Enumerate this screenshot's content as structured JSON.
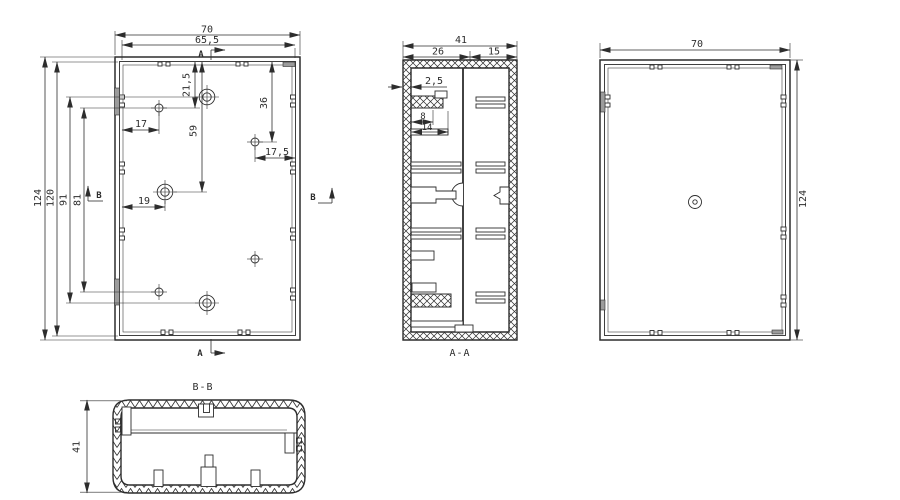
{
  "front_view": {
    "dim_width_outer": "70",
    "dim_width_inner": "65,5",
    "dim_height_outer": "124",
    "dim_height_inner": "120",
    "dim_boss_span": "91",
    "dim_hole_span": "81",
    "dim_hole_offset_x": "17",
    "dim_boss_offset_x": "19",
    "dim_hole_top_offset": "21,5",
    "dim_boss_center_offset": "59",
    "dim_right_hole_offset_y": "36",
    "dim_right_hole_offset_x": "17,5",
    "marker_a": "A",
    "marker_b": "B"
  },
  "section_aa": {
    "label": "A-A",
    "dim_width": "41",
    "dim_seg_left": "26",
    "dim_seg_right": "15",
    "dim_wall_thickness": "2,5",
    "dim_rib_a": "8",
    "dim_rib_b": "14"
  },
  "back_view": {
    "dim_width": "70",
    "dim_height": "124"
  },
  "section_bb": {
    "label": "B-B",
    "dim_height": "41"
  },
  "colors": {
    "line": "#2d2d2d",
    "clip_fill": "#9c9c9c",
    "background": "#ffffff"
  }
}
